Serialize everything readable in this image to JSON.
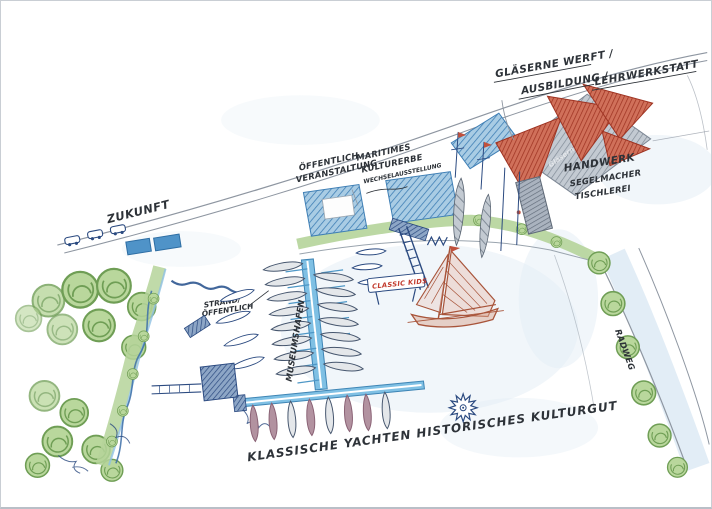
{
  "labels": {
    "werft": {
      "line1": "GLÄSERNE WERFT /",
      "line2": "AUSBILDUNG /",
      "line3": "LEHRWERKSTATT"
    },
    "oeffentlich": {
      "line1": "ÖFFENTLICH",
      "line2": "VERANSTALTUNG"
    },
    "kulturerbe": {
      "line1": "MARITIMES",
      "line2": "KULTURERBE",
      "line3": "WECHSELAUSSTELLUNG"
    },
    "handwerk": {
      "line1": "HANDWERK",
      "line2": "SEGELMACHER",
      "line3": "TISCHLEREI"
    },
    "zukunft": {
      "text": "ZUKUNFT"
    },
    "strand": {
      "line1": "STRAND/",
      "line2": "ÖFFENTLICH"
    },
    "museumshafen": {
      "text": "MUSEUMSHAFEN"
    },
    "classic_kids": {
      "text": "CLASSIC KIDS"
    },
    "radweg": {
      "text": "RADWEG"
    },
    "kulturgut": {
      "text": "KLASSISCHE YACHTEN HISTORISCHES KULTURGUT"
    },
    "werft_watermark": {
      "text": "Gläserne Werft"
    }
  },
  "icons": {
    "sun-doodle": "✳",
    "tree": "●",
    "sailboat": "⛵",
    "car": "▭"
  },
  "colors": {
    "paper": "#ffffff",
    "pencil": "#8e96a1",
    "ink_navy": "#2b4a80",
    "handwriting": "#2d3238",
    "water_wash": "#e4eef6",
    "grass": "#b5d49a",
    "tree_fill": "#b9d79c",
    "tree_stroke": "#6f9e55",
    "building_blue": "#8fc1e0",
    "building_blue_stroke": "#3f7fb5",
    "building_grey": "#b3bac4",
    "sail_red": "#c0503c",
    "jetty_blue": "#7fc0e4",
    "jetty_stroke": "#3e85b5",
    "boat_grey": "#e4e7ea",
    "boat_maroon": "#b292a0",
    "classic_boat_red": "#a8543a",
    "banner_red": "#c23b2e"
  }
}
